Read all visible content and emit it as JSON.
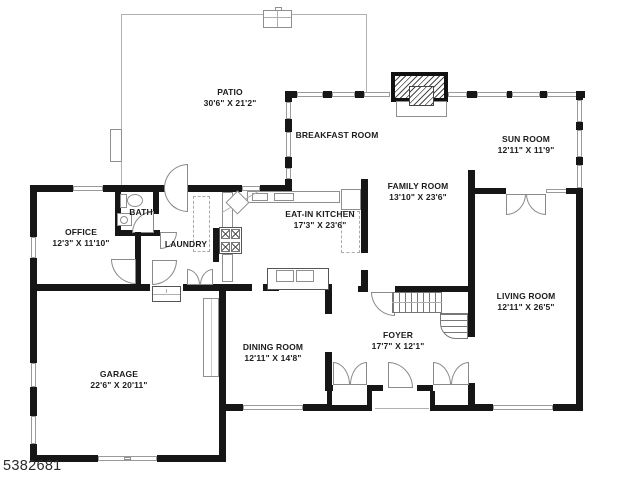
{
  "listing_id": "5382681",
  "rooms": {
    "patio": {
      "name": "PATIO",
      "dims": "30'6\" X 21'2\""
    },
    "breakfast": {
      "name": "BREAKFAST ROOM",
      "dims": ""
    },
    "sunroom": {
      "name": "SUN ROOM",
      "dims": "12'11\" X 11'9\""
    },
    "family": {
      "name": "FAMILY ROOM",
      "dims": "13'10\" X 23'6\""
    },
    "kitchen": {
      "name": "EAT-IN KITCHEN",
      "dims": "17'3\" X 23'6\""
    },
    "office": {
      "name": "OFFICE",
      "dims": "12'3\" X 11'10\""
    },
    "bath": {
      "name": "BATH",
      "dims": ""
    },
    "laundry": {
      "name": "LAUNDRY",
      "dims": ""
    },
    "garage": {
      "name": "GARAGE",
      "dims": "22'6\" X 20'11\""
    },
    "dining": {
      "name": "DINING ROOM",
      "dims": "12'11\" X 14'8\""
    },
    "foyer": {
      "name": "FOYER",
      "dims": "17'7\" X 12'1\""
    },
    "living": {
      "name": "LIVING ROOM",
      "dims": "12'11\" X 26'5\""
    }
  }
}
